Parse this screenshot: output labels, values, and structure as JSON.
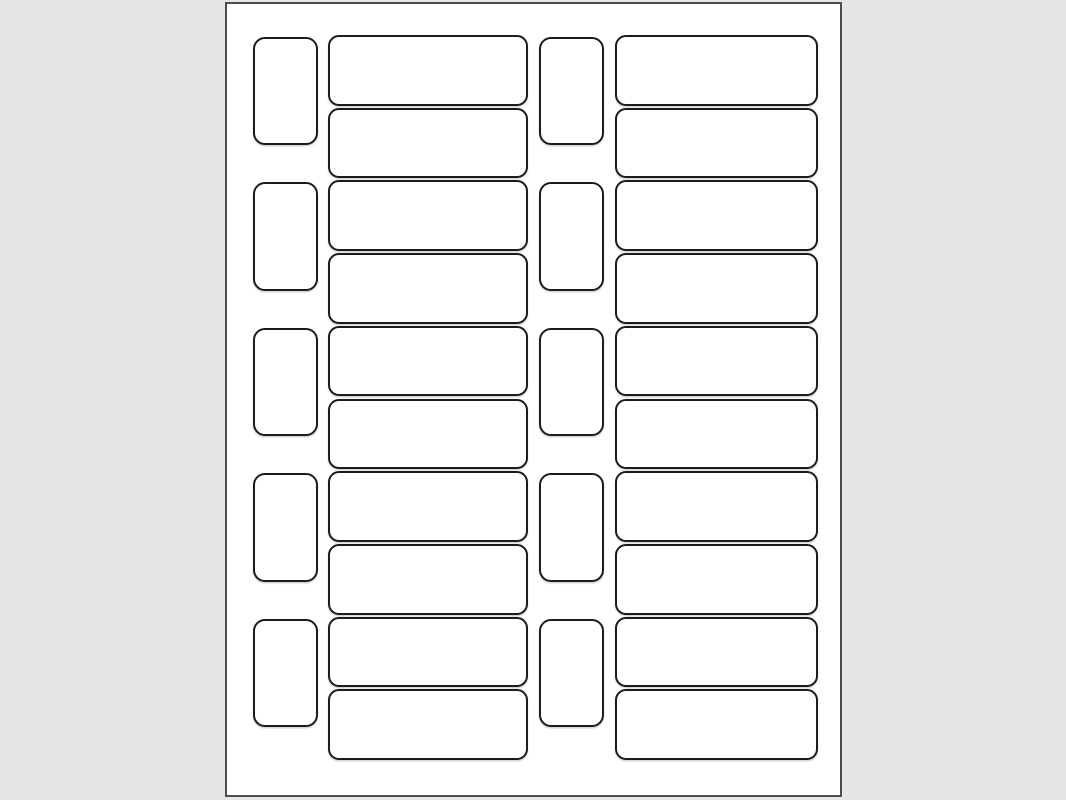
{
  "canvas": {
    "width": 1066,
    "height": 800,
    "background_color": "#e6e6e6"
  },
  "sheet": {
    "name": "blank-label-template-sheet",
    "fill_color": "#ffffff",
    "border_color": "#4d4d4d",
    "border_width": 2,
    "left": 225,
    "top": 2,
    "width": 617,
    "height": 795
  },
  "labels": {
    "fill_color": "#ffffff",
    "border_color": "#1c1c1c",
    "border_width": 2,
    "total_count": 30,
    "columns": [
      {
        "type": "small",
        "x": 26,
        "width": 65,
        "corner_radius": 12,
        "row_count": 5,
        "first_top": 33,
        "row_height": 108.4,
        "row_pitch": 145.4
      },
      {
        "type": "large",
        "x": 101,
        "width": 200,
        "corner_radius": 11,
        "row_count": 10,
        "first_top": 31,
        "row_height": 70.7,
        "row_pitch": 72.7
      },
      {
        "type": "small",
        "x": 312,
        "width": 65,
        "corner_radius": 12,
        "row_count": 5,
        "first_top": 33,
        "row_height": 108.4,
        "row_pitch": 145.4
      },
      {
        "type": "large",
        "x": 388,
        "width": 203,
        "corner_radius": 11,
        "row_count": 10,
        "first_top": 31,
        "row_height": 70.7,
        "row_pitch": 72.7
      }
    ]
  }
}
